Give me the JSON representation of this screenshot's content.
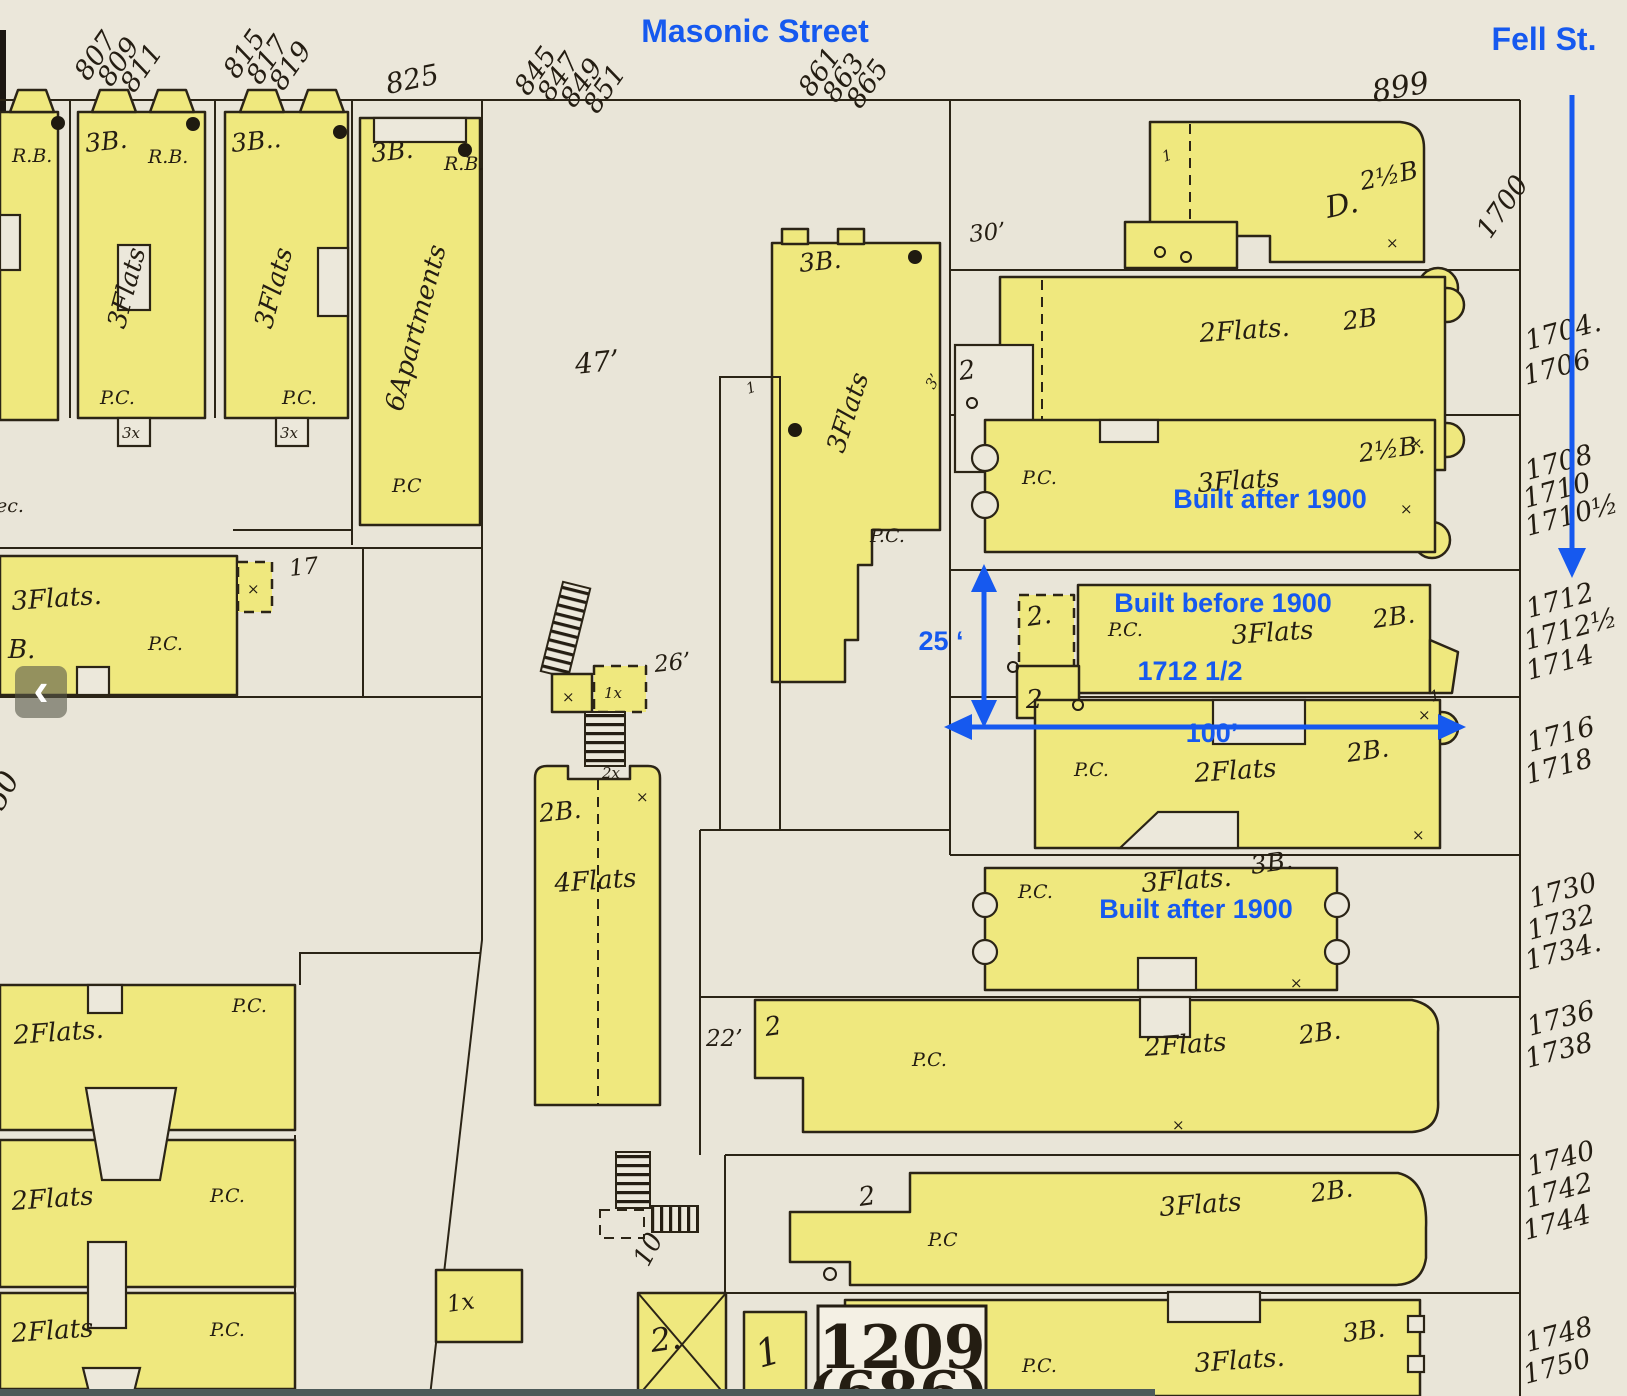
{
  "streets": {
    "masonic": "Masonic Street",
    "fell": "Fell St."
  },
  "notes": {
    "after": "Built after 1900",
    "before": "Built before 1900",
    "mid_addr": "1712 1/2",
    "h25": "25 ‘",
    "w100": "100’"
  },
  "masonic_numbers": [
    "807",
    "809",
    "811",
    "815",
    "817",
    "819",
    "825",
    "845",
    "847",
    "849",
    "851",
    "861",
    "863",
    "865",
    "899"
  ],
  "fell_numbers": [
    "1700",
    "1704.",
    "1706",
    "1708",
    "1710",
    "1710½",
    "1712",
    "1712½",
    "1714",
    "1716",
    "1718",
    "1730",
    "1732",
    "1734.",
    "1736",
    "1738",
    "1740",
    "1742",
    "1744",
    "1748",
    "1750"
  ],
  "labels": {
    "pc": "P.C.",
    "pc2": "P.C",
    "ec": "ec.",
    "flats3": "3Flats",
    "flats3d": "3Flats.",
    "flats2": "2Flats",
    "flats2d": "2Flats.",
    "flats4": "4Flats",
    "apts6": "6Apartments",
    "c3b": "3B.",
    "c3bdd": "3B..",
    "c2b": "2B.",
    "c2bn": "2B",
    "c25b": "2½B",
    "c25bd": "2½B.",
    "rb": "R.B.",
    "bd": "B.",
    "dd": "D.",
    "xm": "×",
    "x3": "3x",
    "x1": "1x",
    "x2": "2x",
    "n1": "1",
    "n2": "2",
    "n2d": "2.",
    "n17": "17",
    "n50": "50",
    "n10": "10",
    "n30": "30’",
    "n47": "47’",
    "n26": "26’",
    "n22": "22’",
    "n3": "3’",
    "block": "1209",
    "block_alt": "(686)"
  },
  "icons": {
    "back": "‹"
  }
}
